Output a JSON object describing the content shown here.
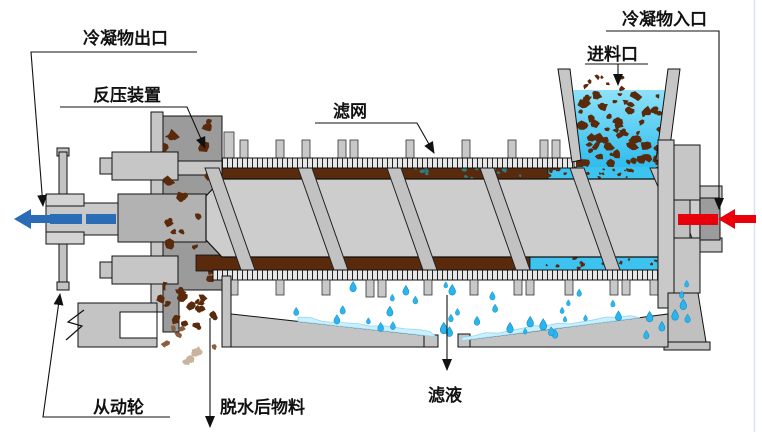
{
  "diagram": {
    "type": "screw-press-dewatering-machine-schematic",
    "labels": {
      "condensate_outlet": "冷凝物出口",
      "back_pressure_device": "反压装置",
      "filter_screen": "滤网",
      "feed_inlet": "进料口",
      "condensate_inlet": "冷凝物入口",
      "driven_wheel": "从动轮",
      "dewatered_material": "脱水后物料",
      "filtrate": "滤液"
    },
    "colors": {
      "condensate_out": "#2a6cb5",
      "condensate_in": "#e8000b",
      "slurry_top": "#8ee2f9",
      "slurry_bottom": "#2fbcee",
      "annulus_water": "#3cc3ef",
      "particle_brown": "#5a2a0c",
      "particle_fade1": "#8a5f3f",
      "particle_fade2": "#c9b39e",
      "teal_patch": "#2f7d80",
      "droplet": "#2ab5ee",
      "droplet_edge": "#0d84ba",
      "water_film": "#cdeffc",
      "water_film_edge": "#8fd9f6",
      "machine_light": "#cdcdcd",
      "machine_mid": "#b2b2b2",
      "housing_dark": "#9b9b9b",
      "screen_fill": "#e6e6e6",
      "outline": "#111111"
    }
  }
}
